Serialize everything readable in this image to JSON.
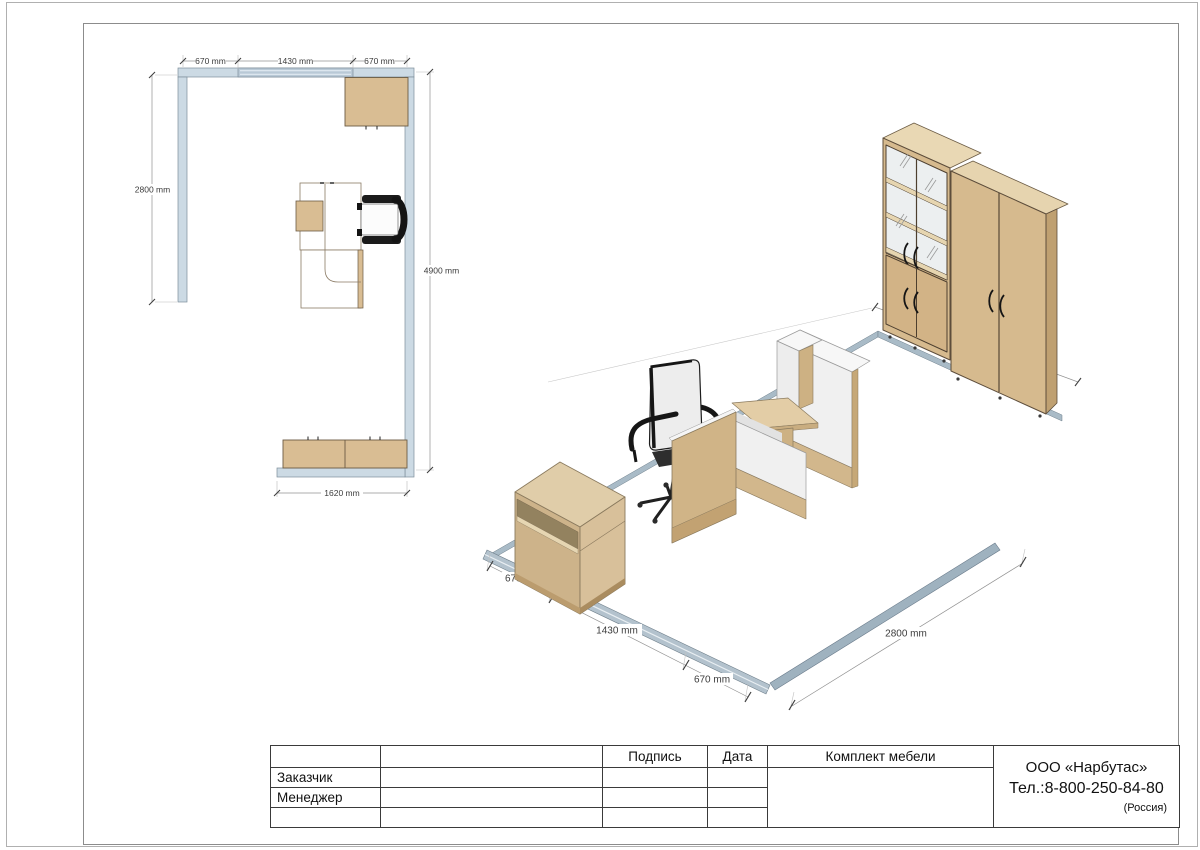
{
  "plan": {
    "dims": {
      "top": [
        "670 mm",
        "1430 mm",
        "670 mm"
      ],
      "left": "2800 mm",
      "right": "4900 mm",
      "bottom": "1620 mm"
    }
  },
  "iso": {
    "dims": {
      "wall_segments": [
        "670 mm",
        "1430 mm",
        "670 mm"
      ],
      "side_wall": "2800 mm"
    }
  },
  "title_block": {
    "col_signature": "Подпись",
    "col_date": "Дата",
    "kit_label": "Комплект мебели",
    "row_customer": "Заказчик",
    "row_manager": "Менеджер",
    "company": {
      "name": "ООО «Нарбутас»",
      "phone": "Тел.:8-800-250-84-80",
      "country": "(Россия)"
    }
  },
  "colors": {
    "wall": "#ccdae4",
    "window": "#b9c9d6",
    "baseboard": "#b3c2cd",
    "wood_front": "#d6ba8e",
    "wood_top": "#e7d6b2",
    "panel_white": "#f0f0f0",
    "outline": "#6b5b44"
  }
}
